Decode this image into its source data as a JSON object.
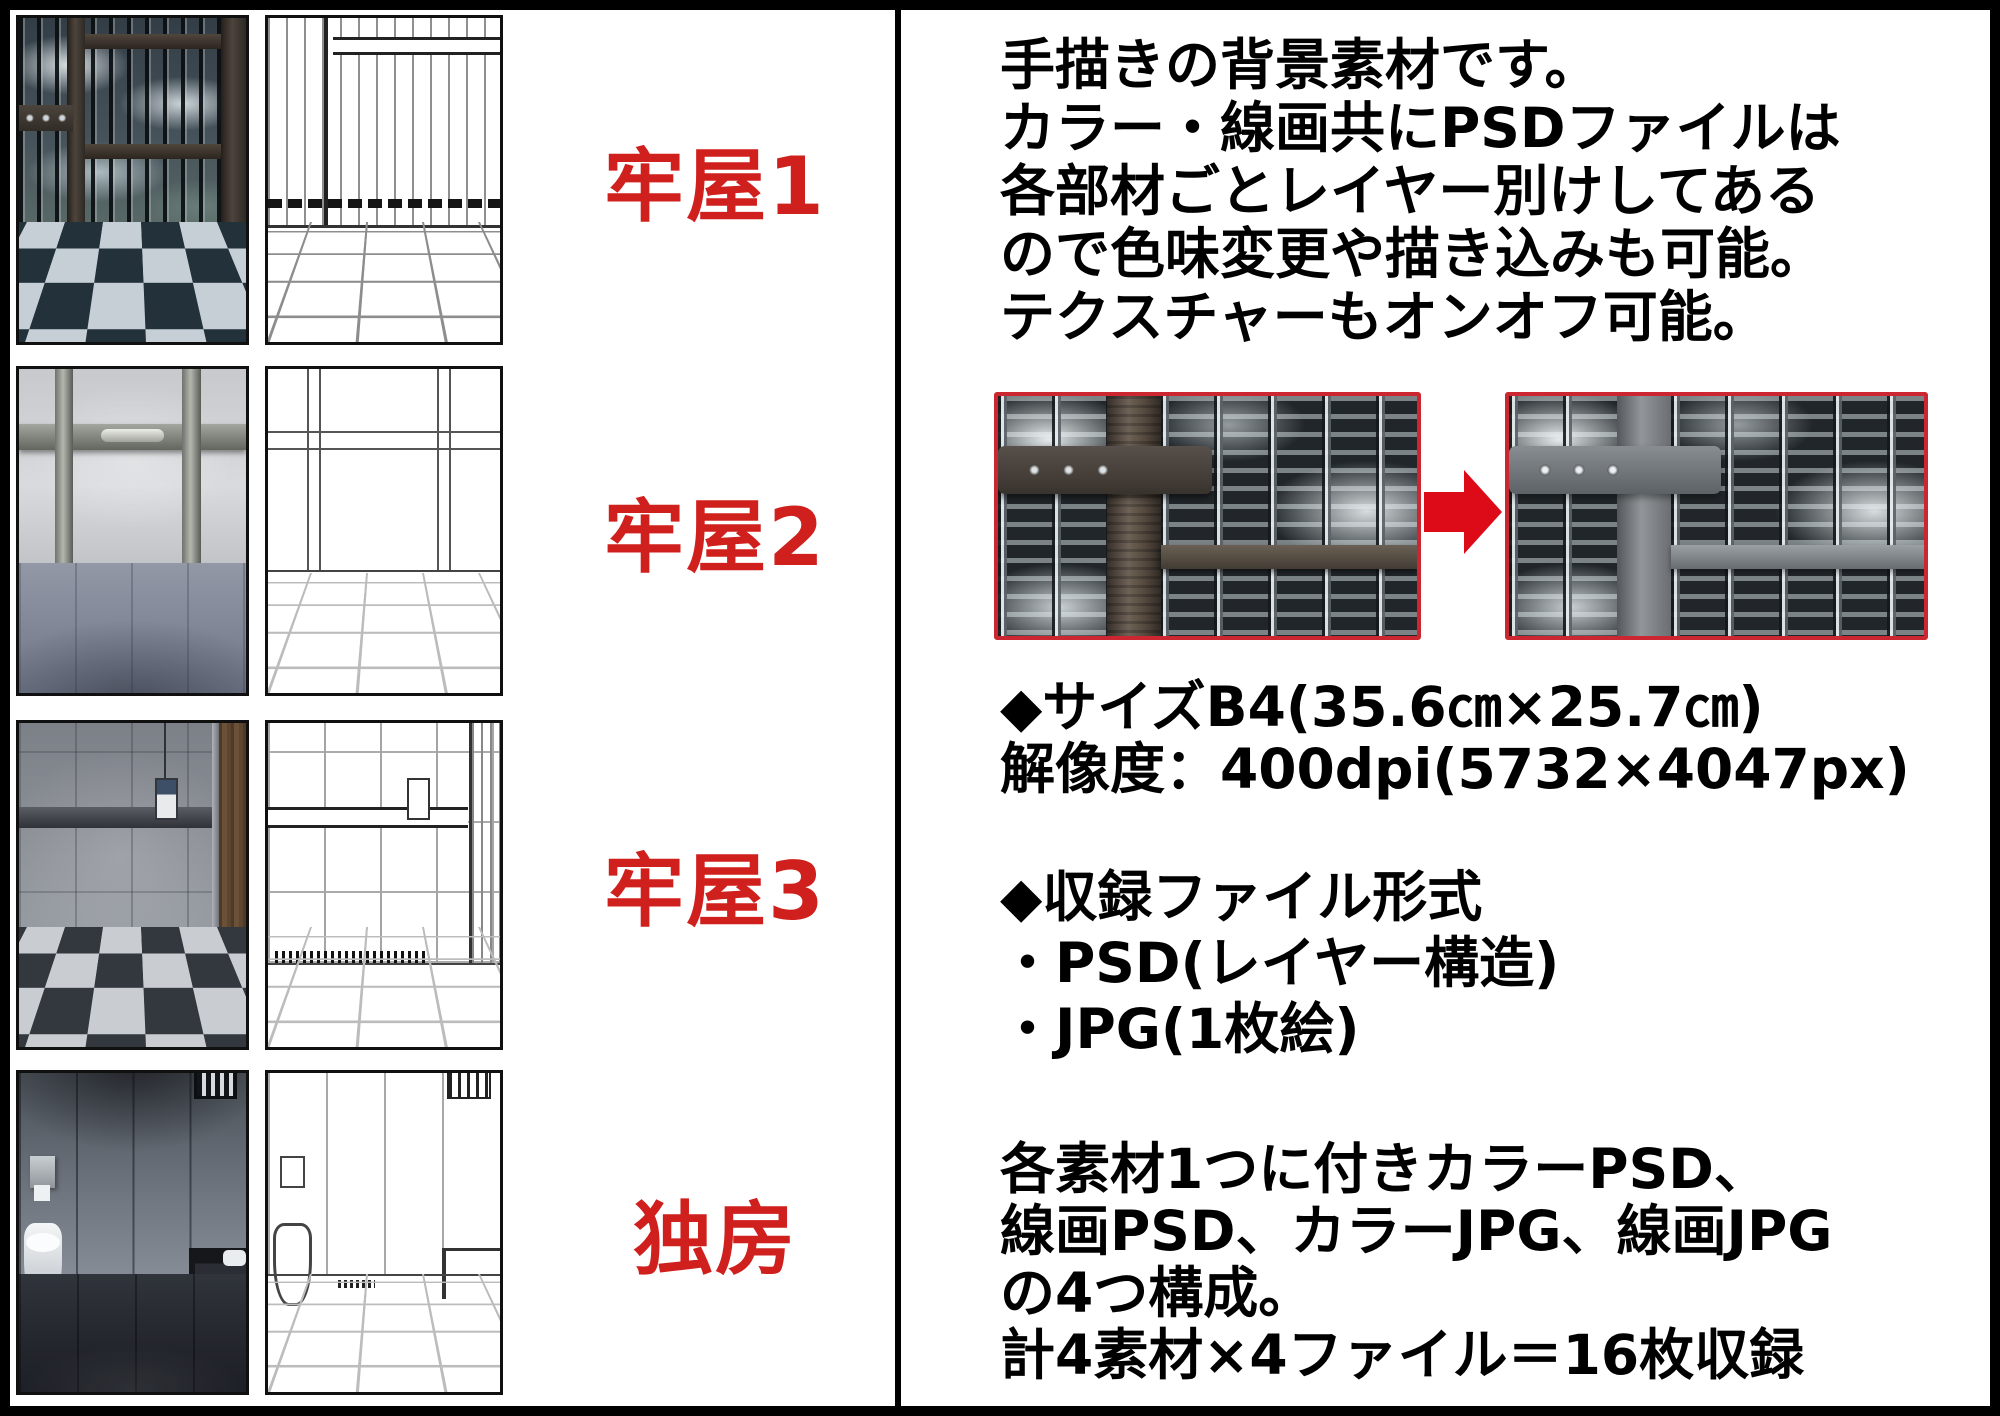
{
  "page": {
    "type": "product-description-sheet",
    "language": "ja"
  },
  "colors": {
    "label-red": "#d0201d",
    "compare-border-red": "#cc2631",
    "arrow-red": "#dd0a18",
    "frame-black": "#000000"
  },
  "left_panel": {
    "rows": [
      {
        "label": "牢屋1",
        "color_image": "jail-room-1-color",
        "line_image": "jail-room-1-lineart"
      },
      {
        "label": "牢屋2",
        "color_image": "jail-room-2-color",
        "line_image": "jail-room-2-lineart"
      },
      {
        "label": "牢屋3",
        "color_image": "jail-room-3-color",
        "line_image": "jail-room-3-lineart"
      },
      {
        "label": "独房",
        "color_image": "solitary-cell-color",
        "line_image": "solitary-cell-lineart"
      }
    ]
  },
  "right_panel": {
    "intro_lines": [
      "手描きの背景素材です。",
      "カラー・線画共にPSDファイルは",
      "各部材ごとレイヤー別けしてある",
      "ので色味変更や描き込みも可能。",
      "テクスチャーもオンオフ可能。"
    ],
    "comparison": {
      "before_image": "texture-on-sample",
      "after_image": "texture-off-sample",
      "arrow_icon": "arrow-right"
    },
    "size_lines": [
      "◆サイズB4(35.6㎝×25.7㎝)",
      "解像度：400dpi(5732×4047px)"
    ],
    "format_lines": [
      "◆収録ファイル形式",
      "・PSD(レイヤー構造)",
      "・JPG(1枚絵)"
    ],
    "composition_lines": [
      "各素材1つに付きカラーPSD、",
      "線画PSD、カラーJPG、線画JPG",
      "の4つ構成。",
      "計4素材×4ファイル＝16枚収録"
    ]
  }
}
